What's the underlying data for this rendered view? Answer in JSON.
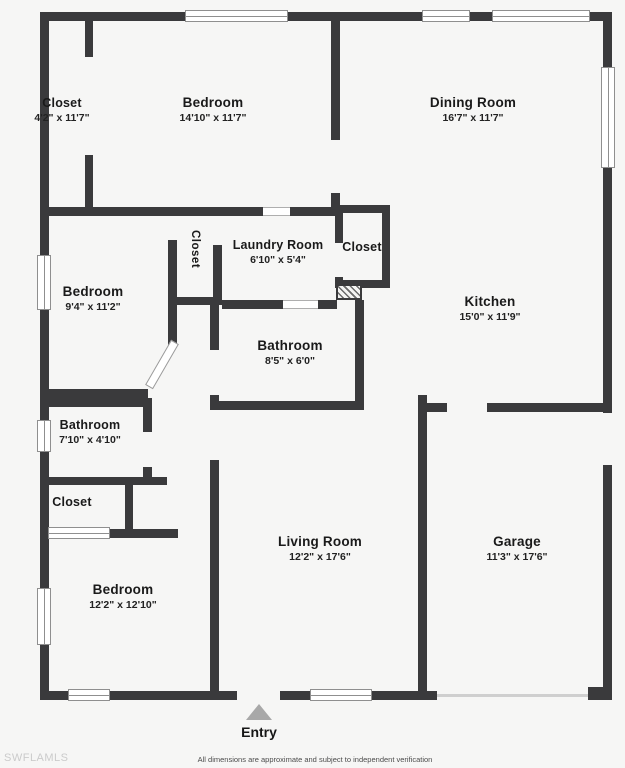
{
  "title": "Floor plan",
  "colors": {
    "wall": "#3a3a3c",
    "background": "#f6f6f5",
    "window_border": "#8f8f8f",
    "entry_arrow": "#a8a8a8",
    "watermark": "#cbcbcb"
  },
  "rooms": [
    {
      "name": "Closet",
      "dims": "4'2\" x 11'7\""
    },
    {
      "name": "Bedroom",
      "dims": "14'10\" x 11'7\""
    },
    {
      "name": "Dining Room",
      "dims": "16'7\" x 11'7\""
    },
    {
      "name": "Bedroom",
      "dims": "9'4\" x 11'2\""
    },
    {
      "name": "Closet",
      "dims": ""
    },
    {
      "name": "Laundry Room",
      "dims": "6'10\" x 5'4\""
    },
    {
      "name": "Closet",
      "dims": ""
    },
    {
      "name": "Kitchen",
      "dims": "15'0\" x 11'9\""
    },
    {
      "name": "Bathroom",
      "dims": "8'5\" x 6'0\""
    },
    {
      "name": "Bathroom",
      "dims": "7'10\" x 4'10\""
    },
    {
      "name": "Closet",
      "dims": ""
    },
    {
      "name": "Bedroom",
      "dims": "12'2\" x 12'10\""
    },
    {
      "name": "Living Room",
      "dims": "12'2\" x 17'6\""
    },
    {
      "name": "Garage",
      "dims": "11'3\" x 17'6\""
    }
  ],
  "entry_label": "Entry",
  "watermark": "SWFLAMLS",
  "disclaimer": "All dimensions are approximate and subject to independent verification"
}
